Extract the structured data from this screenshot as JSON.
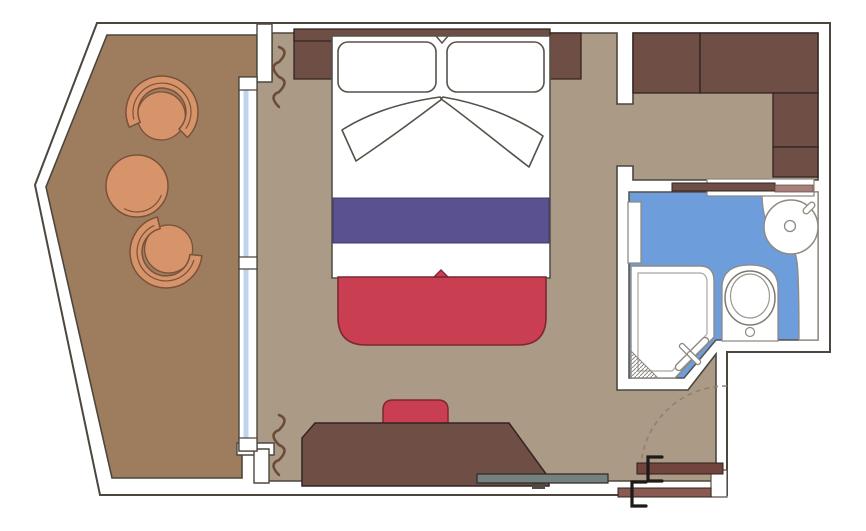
{
  "title": "cruise-cabin-floor-plan",
  "colors": {
    "background": "#ffffff",
    "wall_fill": "#ffffff",
    "outline": "#4c463e",
    "balcony_floor": "#9e7c5e",
    "cabin_floor": "#ab9a86",
    "bathroom_floor": "#6e9ddb",
    "glass_blue": "#bdd5ee",
    "dark_wood": "#6f4e45",
    "furniture_outline": "#332520",
    "red_upholstery": "#ca3e52",
    "red_outline": "#7e2733",
    "purple_runner": "#5a5190",
    "purple_outline": "#3f3a6b",
    "chair_orange": "#d7946b",
    "chair_outline": "#7a523a",
    "shelf_gray": "#74817f",
    "shelf_foot": "#4f4a45",
    "door_panel_inner": "#71453d",
    "door_panel_outer": "#8a5a52",
    "mauve_bar": "#a5807a",
    "fixture_white": "#ffffff",
    "fixture_outline": "#8e8b83",
    "handle_black": "#1e1a17",
    "curtain_brown": "#6b4a38",
    "swing_arc": "#8f8172",
    "bed_outline": "#56524a"
  },
  "inventory": {
    "balcony": [
      "tub-chair",
      "round-table",
      "tub-chair"
    ],
    "bedroom": [
      "headboard",
      "nightstand-left",
      "nightstand-right",
      "double-bed",
      "pillows",
      "folded-sheets",
      "purple-bed-runner",
      "red-bench",
      "desk",
      "desk-chair",
      "wall-shelf",
      "curtains",
      "glass-balcony-door"
    ],
    "wardrobe_corner": [
      "wardrobe-unit",
      "wardrobe-unit",
      "wardrobe-unit",
      "wardrobe-unit"
    ],
    "bathroom": [
      "shower",
      "shower-door",
      "toilet",
      "round-sink",
      "faucet",
      "towel-shelf",
      "door-leaf"
    ],
    "entrance": [
      "entry-door-open",
      "entry-door-threshold",
      "door-swing-arc",
      "door-handles"
    ]
  }
}
